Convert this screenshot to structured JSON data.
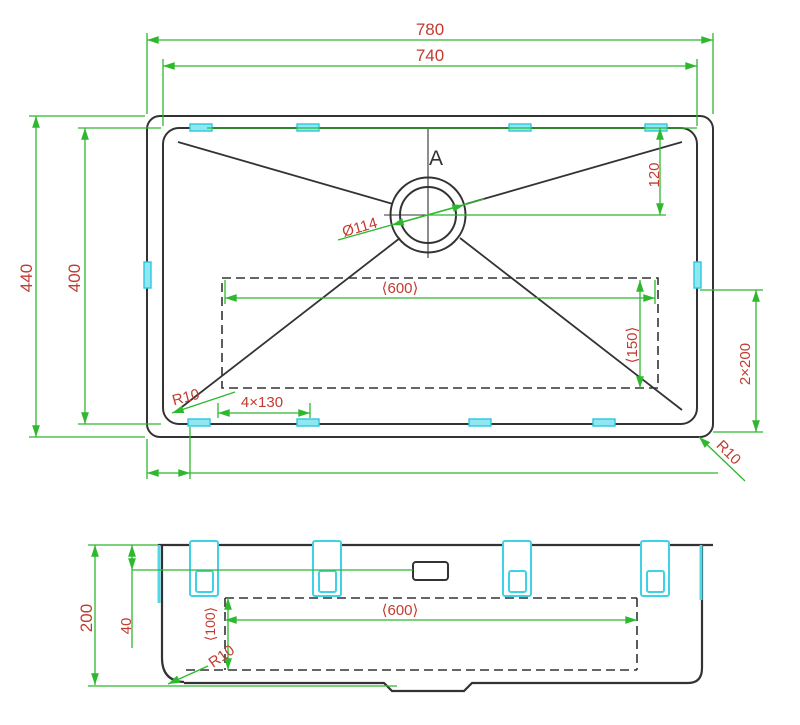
{
  "colors": {
    "background": "#ffffff",
    "outline": "#333333",
    "dimension_line": "#2eb82e",
    "dimension_text": "#c23b30",
    "mounting_clip": "#4fd8e8"
  },
  "top_view": {
    "width_outer": "780",
    "width_inner": "740",
    "height_outer": "440",
    "height_inner": "400",
    "drain_offset": "120",
    "drain_diameter": "Ø114",
    "section_label": "A",
    "pad_width": "⟨600⟩",
    "pad_height": "⟨150⟩",
    "double_spacing": "2×200",
    "clip_spacing": "4×130",
    "radius_bottom_left": "R10",
    "radius_bottom_right": "R10"
  },
  "front_view": {
    "overall_height": "200",
    "rim_offset": "40",
    "pad_width": "⟨600⟩",
    "pad_depth": "⟨100⟩",
    "corner_radius": "R10"
  }
}
